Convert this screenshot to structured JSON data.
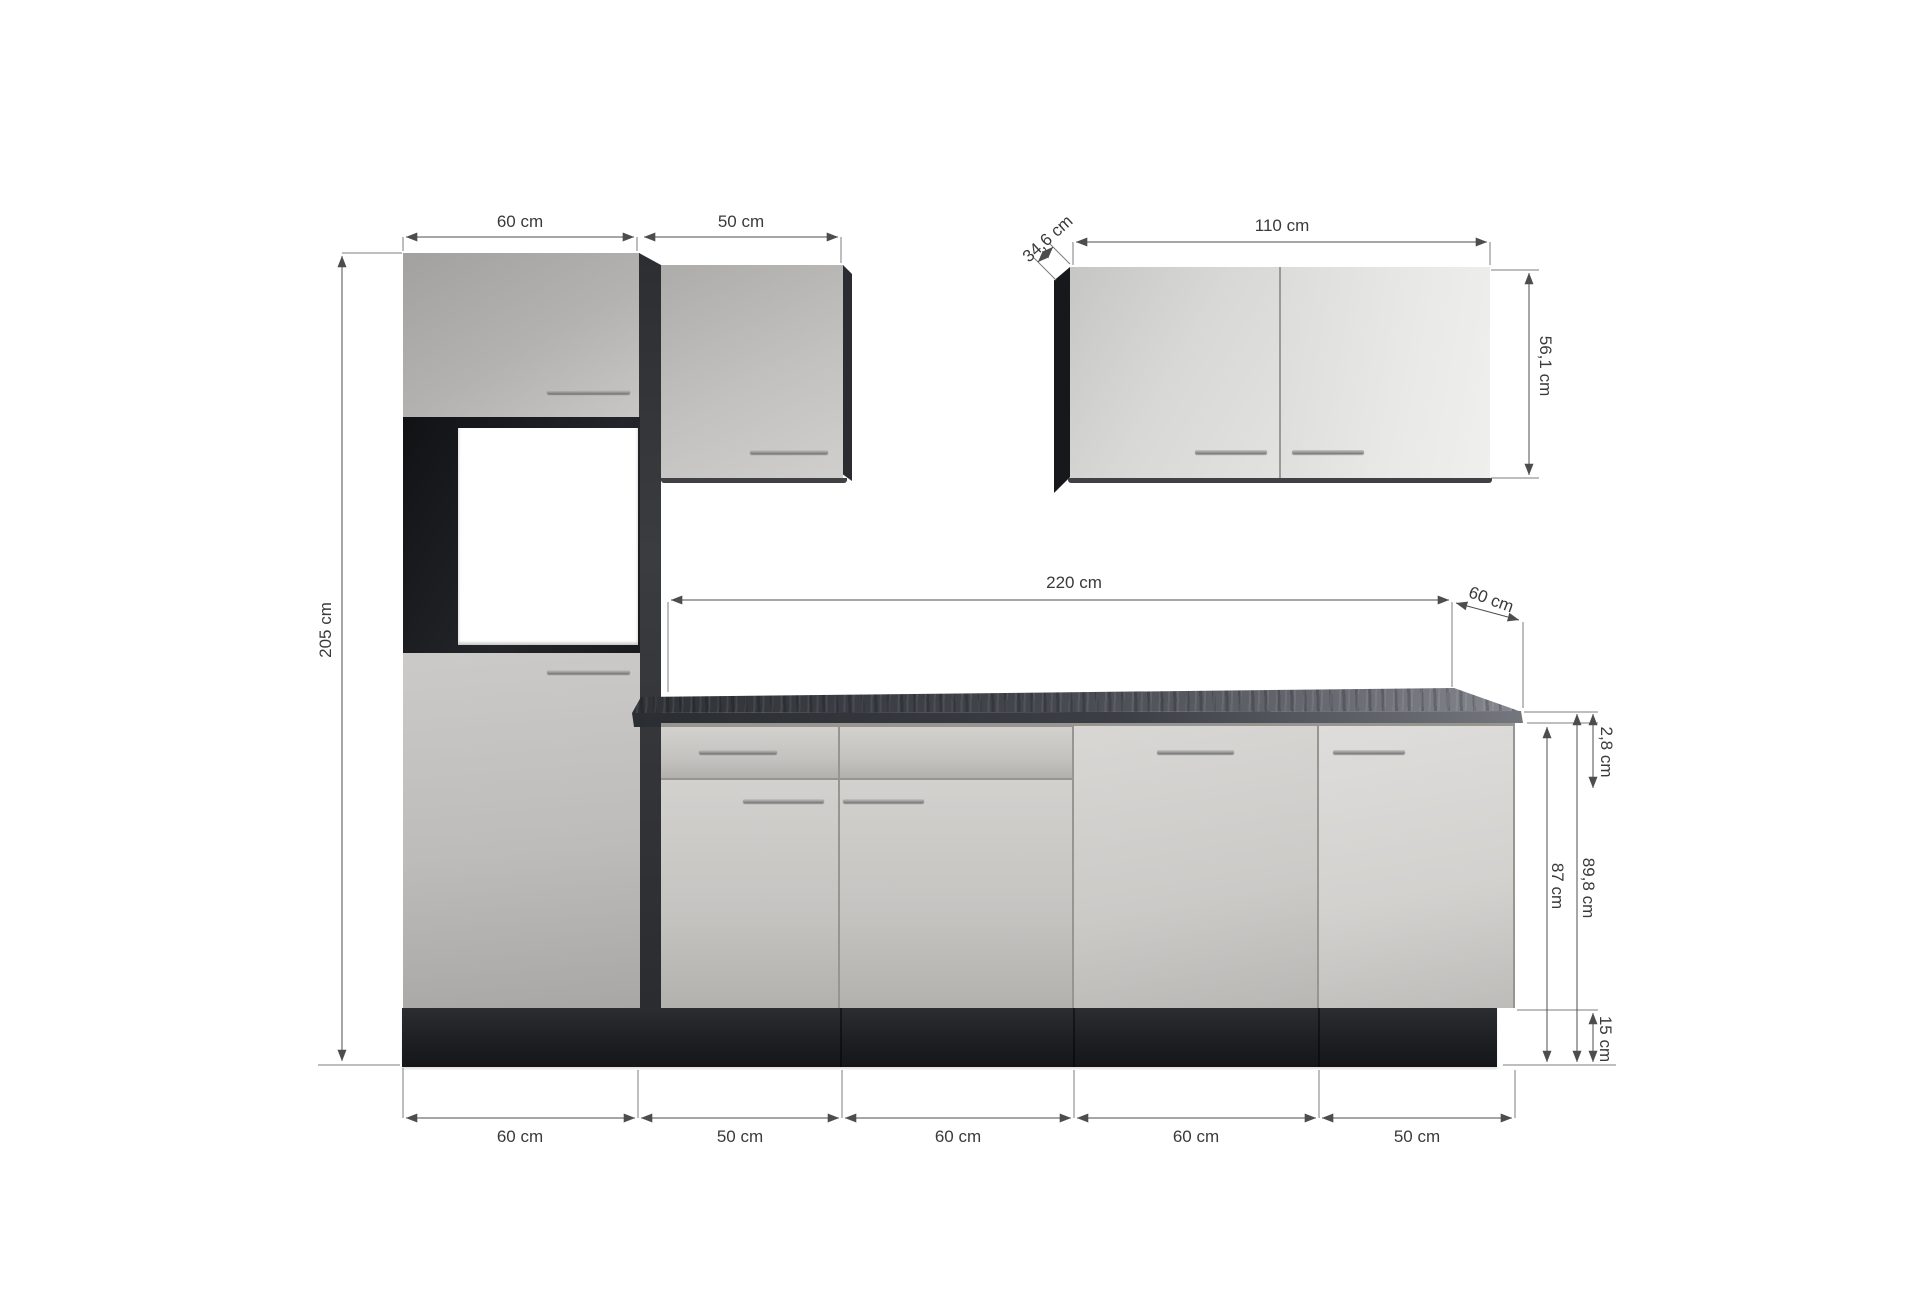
{
  "diagram": {
    "dims": {
      "tall_unit_width": "60 cm",
      "wall_cabinet_small_width": "50 cm",
      "wall_cabinet_large_width": "110 cm",
      "wall_cabinet_large_depth": "34,6 cm",
      "wall_cabinet_large_height": "56,1 cm",
      "worktop_length": "220 cm",
      "worktop_depth": "60 cm",
      "worktop_thickness": "2,8 cm",
      "height_with_worktop": "89,8 cm",
      "base_unit_height": "87 cm",
      "plinth_height": "15 cm",
      "total_height": "205 cm",
      "base_segments": [
        "60 cm",
        "50 cm",
        "60 cm",
        "60 cm",
        "50 cm"
      ]
    },
    "colors": {
      "front_grey": "#c9c8c6",
      "front_light_grey": "#e6e6e4",
      "carcass_anthracite": "#222428",
      "plinth_black": "#1d1f22",
      "worktop_concrete": "#3d4047",
      "handle_metal": "#9b9b99",
      "dimension_line": "#4d4d4d",
      "background": "#ffffff"
    }
  }
}
